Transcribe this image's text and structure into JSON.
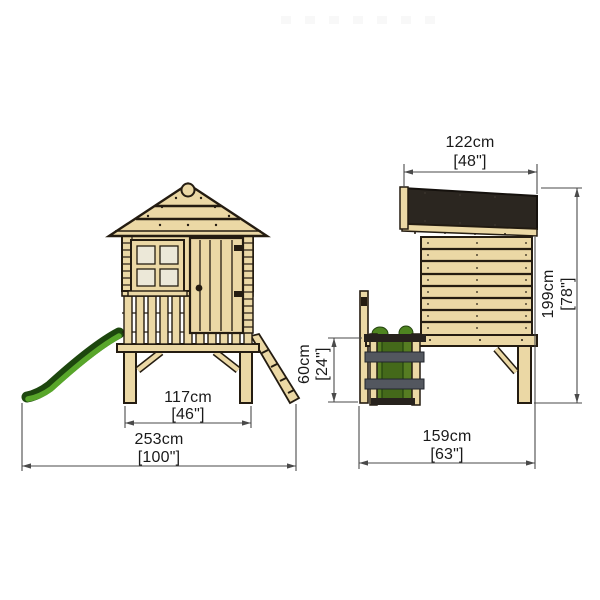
{
  "page": {
    "background": "#ffffff",
    "description": "Dimension drawing of a wooden tower playhouse with slide and step ladder, front and side elevations"
  },
  "diagram": {
    "views": {
      "front_elevation": {
        "name": "front elevation with slide and access ramp",
        "dimensions": {
          "stilt_base_width": {
            "metric": "117cm",
            "imperial": "[46\"]"
          },
          "overall_width": {
            "metric": "253cm",
            "imperial": "[100\"]"
          }
        }
      },
      "side_elevation": {
        "name": "side elevation with step ladder",
        "dimensions": {
          "roof_depth": {
            "metric": "122cm",
            "imperial": "[48\"]"
          },
          "overall_height": {
            "metric": "199cm",
            "imperial": "[78\"]"
          },
          "step_height": {
            "metric": "60cm",
            "imperial": "[24\"]"
          },
          "overall_depth": {
            "metric": "159cm",
            "imperial": "[63\"]"
          }
        }
      }
    },
    "colors": {
      "timber": "#ebd8a5",
      "timber_outline": "#241c11",
      "roof_panel": "#2b2620",
      "slide_green": "#55a228",
      "slide_green_dark": "#1d470e",
      "ladder_step_gray": "#53575f",
      "window_glass": "#ece8d8",
      "dimension_line": "#4a4a4a",
      "dimension_text": "#1a1a1a"
    }
  }
}
